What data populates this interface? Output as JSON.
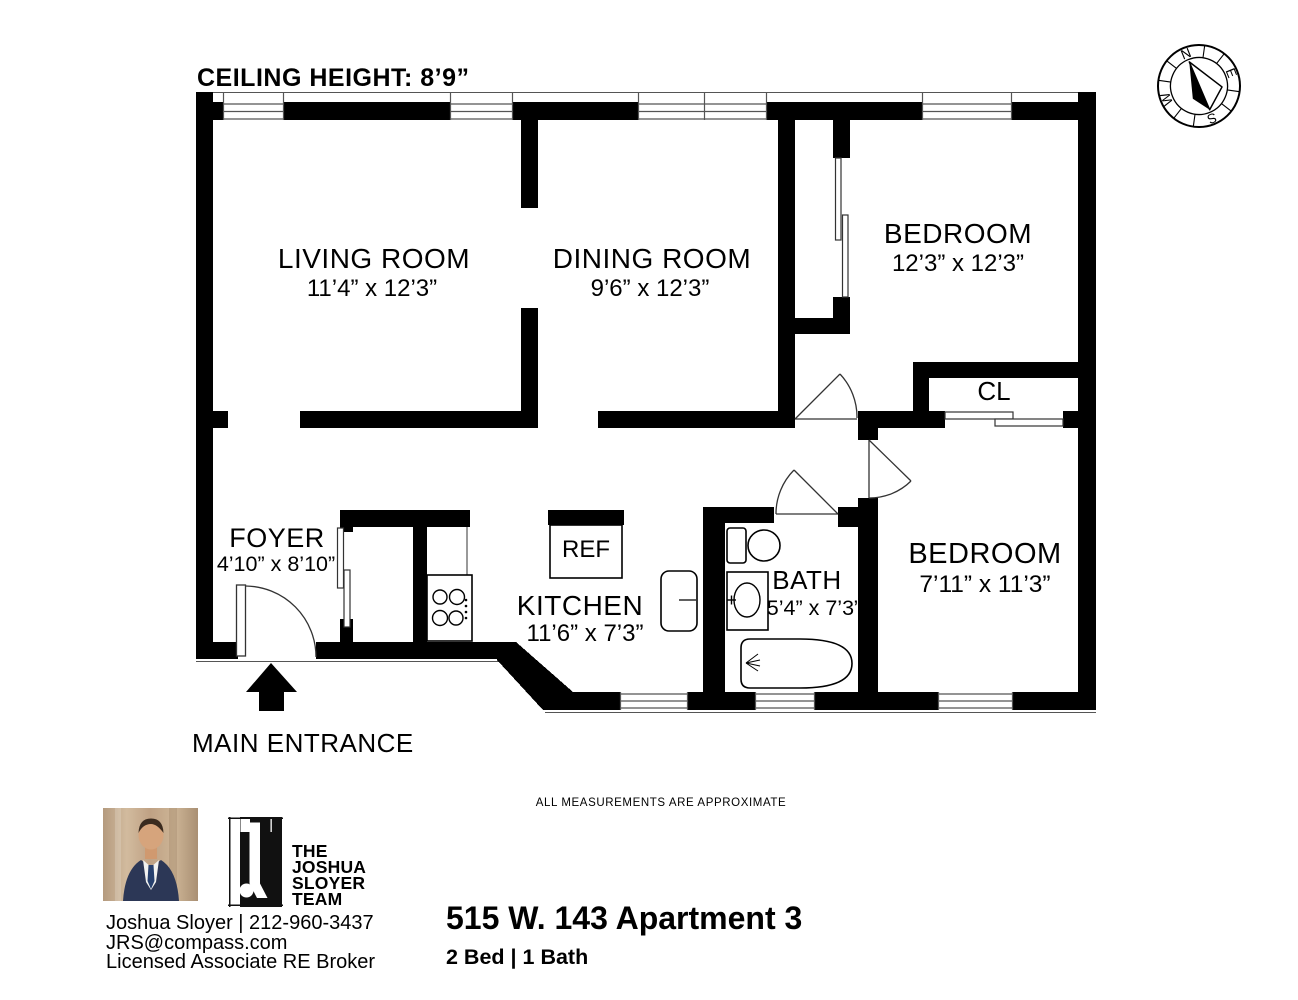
{
  "plan": {
    "ceiling_height": "CEILING HEIGHT: 8’9”",
    "disclaimer": "ALL MEASUREMENTS  ARE  APPROXIMATE",
    "main_entrance": "MAIN ENTRANCE",
    "rooms": {
      "living": {
        "name": "LIVING ROOM",
        "dims": "11’4”  x 12’3”"
      },
      "dining": {
        "name": "DINING ROOM",
        "dims": "9’6”  x 12’3”"
      },
      "bedroom1": {
        "name": "BEDROOM",
        "dims": "12’3”  x 12’3”"
      },
      "closet": {
        "name": "CL"
      },
      "foyer": {
        "name": "FOYER",
        "dims": "4’10” x 8’10”"
      },
      "kitchen": {
        "name": "KITCHEN",
        "dims": "11’6”  x 7’3”"
      },
      "fridge": {
        "name": "REF"
      },
      "bath": {
        "name": "BATH",
        "dims": "5’4” x 7’3”"
      },
      "bedroom2": {
        "name": "BEDROOM",
        "dims": "7’11” x 11’3”"
      }
    }
  },
  "compass": {
    "north": "N",
    "east": "E",
    "south": "S",
    "west": "W"
  },
  "footer": {
    "team_lines": {
      "l1": "THE",
      "l2": "JOSHUA",
      "l3": "SLOYER",
      "l4": "TEAM"
    },
    "agent_line": "Joshua Sloyer | 212-960-3437",
    "email": "JRS@compass.com",
    "license": "Licensed Associate  RE Broker",
    "listing_title": "515 W. 143 Apartment 3",
    "listing_details": "2 Bed | 1 Bath"
  }
}
